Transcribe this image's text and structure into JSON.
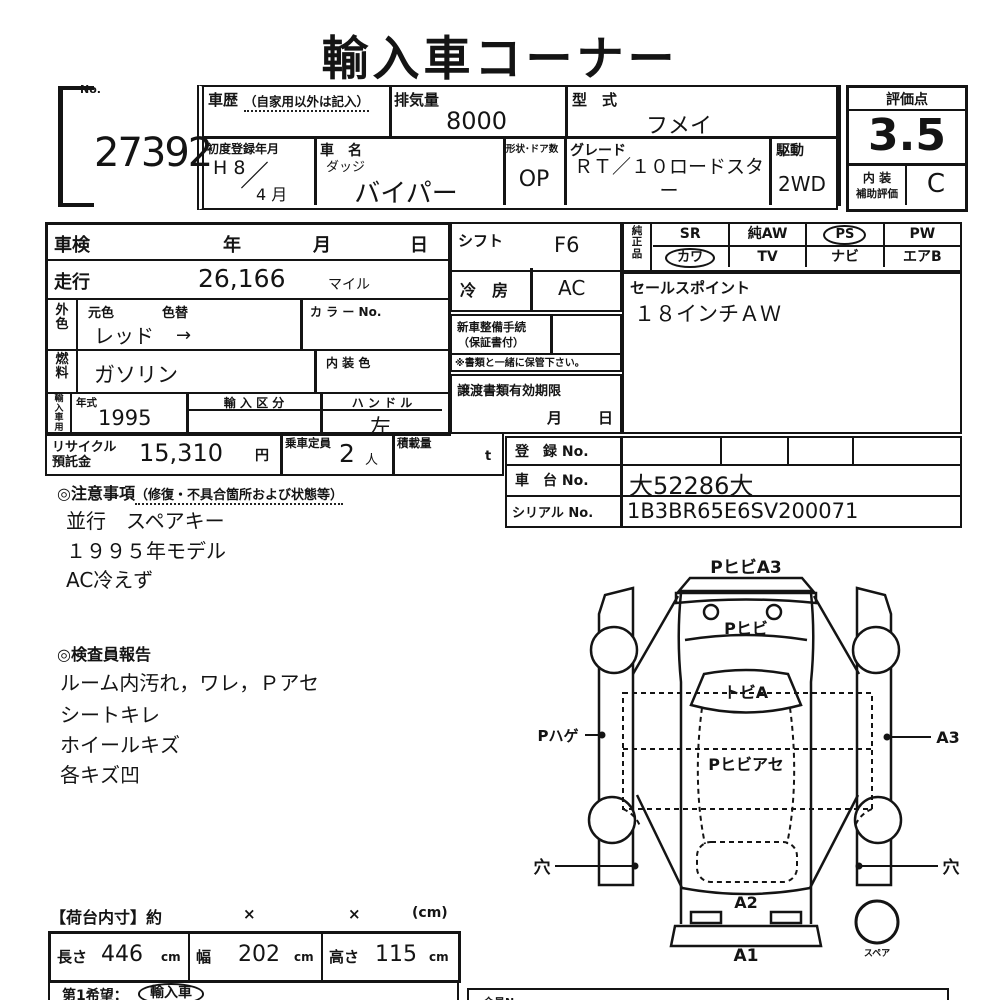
{
  "title": "輸入車コーナー",
  "lot": {
    "no_label": "No.",
    "number": "27392"
  },
  "header": {
    "history_label": "車歴",
    "history_note": "（自家用以外は記入）",
    "displacement_label": "排気量",
    "displacement_value": "8000",
    "model_code_label": "型　式",
    "model_code_value": "フメイ",
    "first_reg_label": "初度登録年月",
    "first_reg_era": "H 8",
    "first_reg_slash": "／",
    "first_reg_month": "4 月",
    "car_name_label": "車　名",
    "car_maker": "ダッジ",
    "car_name_value": "バイパー",
    "shape_doors_label": "形状･ドア数",
    "shape_doors_value": "OP",
    "grade_label": "グレード",
    "grade_value": "ＲＴ／１０ロードスター",
    "drive_label": "駆動",
    "drive_value": "2WD"
  },
  "score": {
    "label": "評価点",
    "value": "3.5",
    "interior_label_1": "内 装",
    "interior_label_2": "補助評価",
    "interior_value": "C"
  },
  "inspection": {
    "shaken_label": "車検",
    "year_label": "年",
    "month_label": "月",
    "day_label": "日"
  },
  "mileage": {
    "label": "走行",
    "value": "26,166",
    "unit": "マイル"
  },
  "color": {
    "group_label": "外色",
    "orig_label": "元色",
    "change_label": "色替",
    "value": "レッド",
    "arrow": "→",
    "color_no_label": "カ ラ ー No."
  },
  "fuel": {
    "group_label": "燃料",
    "value": "ガソリン",
    "interior_color_label": "内 装 色"
  },
  "import": {
    "group_label": "輸入車用",
    "year_label": "年式",
    "year_value": "1995",
    "class_label": "輸 入 区 分",
    "handle_label": "ハ ン ド ル",
    "handle_value": "左"
  },
  "shift": {
    "label": "シフト",
    "value": "F6"
  },
  "aircon": {
    "label": "冷　房",
    "value": "AC"
  },
  "new_car": {
    "label_1": "新車整備手続",
    "label_2": "（保証書付）",
    "note": "※書類と一緒に保管下さい。"
  },
  "transfer": {
    "label": "譲渡書類有効期限",
    "month_label": "月",
    "day_label": "日"
  },
  "equipment": {
    "label": "純正品",
    "row1": [
      "SR",
      "純AW",
      "PS",
      "PW"
    ],
    "row2": [
      "カワ",
      "TV",
      "ナビ",
      "エアB"
    ],
    "circled": [
      "PS",
      "カワ"
    ]
  },
  "sales_point": {
    "label": "セールスポイント",
    "value": "１８インチＡＷ"
  },
  "recycle": {
    "label_1": "リサイクル",
    "label_2": "預託金",
    "value": "15,310",
    "unit": "円",
    "capacity_label": "乗車定員",
    "capacity_value": "2",
    "capacity_unit": "人",
    "load_label": "積載量",
    "load_unit": "t"
  },
  "registration": {
    "reg_label": "登　録 No.",
    "chassis_label": "車　台 No.",
    "chassis_value": "大52286大",
    "serial_label": "シリアル No.",
    "serial_value": "1B3BR65E6SV200071"
  },
  "notes": {
    "heading": "◎注意事項",
    "heading_note": "（修復・不具合箇所および状態等）",
    "items": [
      "並行　スペアキー",
      "１９９５年モデル",
      "AC冷えず"
    ]
  },
  "inspector": {
    "heading": "◎検査員報告",
    "items": [
      "ルーム内汚れ，ワレ，Ｐアセ",
      "シートキレ",
      "ホイールキズ",
      "各キズ凹"
    ]
  },
  "diagram": {
    "front_bumper": "PヒビA3",
    "front_panel": "Pヒビ",
    "windshield": "トビA",
    "roof": "Pヒビアセ",
    "left_door": "Pハゲ",
    "right_door": "A3",
    "left_hole": "穴",
    "right_hole": "穴",
    "rear_panel": "A2",
    "rear_bumper": "A1",
    "spare": "スペア"
  },
  "cargo": {
    "heading": "【荷台内寸】約",
    "x1": "×",
    "x2": "×",
    "unit": "(cm)",
    "length_label": "長さ",
    "length_value": "446",
    "length_unit": "cm",
    "width_label": "幅",
    "width_value": "202",
    "width_unit": "cm",
    "height_label": "高さ",
    "height_value": "115",
    "height_unit": "cm"
  },
  "footer": {
    "choice_label": "第1希望：",
    "choice_value": "輸入車",
    "member_label": "会員No"
  }
}
